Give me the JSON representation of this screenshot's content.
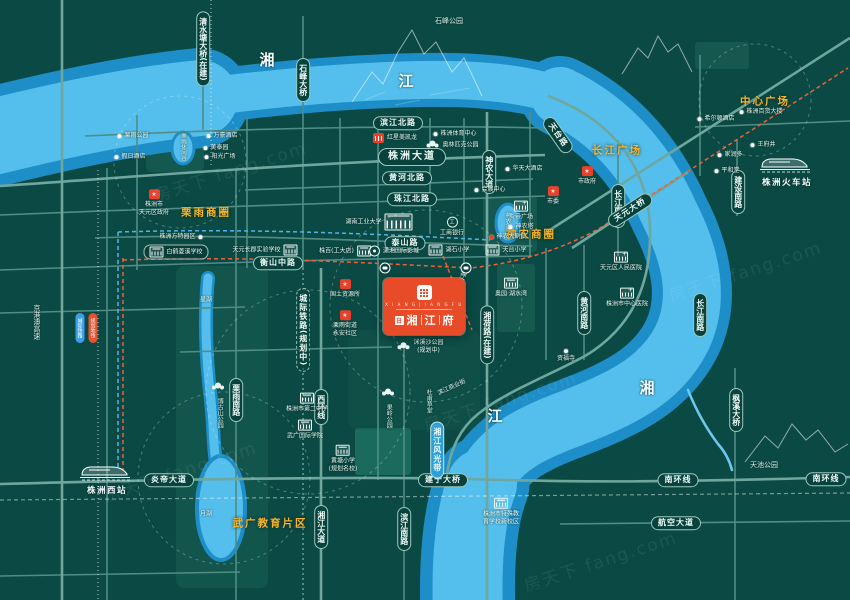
{
  "project": {
    "seal": "日",
    "name": [
      "湘",
      "江",
      "府"
    ],
    "latin": "X I A N G J I A N G F U"
  },
  "area_labels": [
    {
      "text": "栗雨商圈",
      "x": 206,
      "y": 212
    },
    {
      "text": "神农商圈",
      "x": 531,
      "y": 234
    },
    {
      "text": "长江广场",
      "x": 617,
      "y": 150
    },
    {
      "text": "中心广场",
      "x": 765,
      "y": 101
    },
    {
      "text": "武广教育片区",
      "x": 270,
      "y": 523
    }
  ],
  "road_labels": [
    {
      "text": "滨江北路",
      "x": 398,
      "y": 123,
      "style": "h"
    },
    {
      "text": "株洲大道",
      "x": 412,
      "y": 157,
      "style": "lg"
    },
    {
      "text": "黄河北路",
      "x": 407,
      "y": 178,
      "style": "h"
    },
    {
      "text": "珠江北路",
      "x": 412,
      "y": 199,
      "style": "h"
    },
    {
      "text": "泰山路",
      "x": 405,
      "y": 243,
      "style": "h"
    },
    {
      "text": "衡山中路",
      "x": 278,
      "y": 263,
      "style": "h"
    },
    {
      "text": "炎帝大道",
      "x": 169,
      "y": 480,
      "style": "h"
    },
    {
      "text": "建宁大桥",
      "x": 443,
      "y": 480,
      "style": "h"
    },
    {
      "text": "南环线",
      "x": 678,
      "y": 480,
      "style": "h"
    },
    {
      "text": "南环线",
      "x": 826,
      "y": 479,
      "style": "h"
    },
    {
      "text": "航空大道",
      "x": 676,
      "y": 523,
      "style": "h"
    },
    {
      "text": "神农大道",
      "x": 489,
      "y": 172,
      "style": "v"
    },
    {
      "text": "湘荷路(在建)",
      "x": 487,
      "y": 335,
      "style": "v"
    },
    {
      "text": "栗雨南路",
      "x": 236,
      "y": 400,
      "style": "v"
    },
    {
      "text": "西环线",
      "x": 321,
      "y": 407,
      "style": "v"
    },
    {
      "text": "湘江大道",
      "x": 321,
      "y": 527,
      "style": "v"
    },
    {
      "text": "滨江南路",
      "x": 404,
      "y": 529,
      "style": "v"
    },
    {
      "text": "黄河南路",
      "x": 584,
      "y": 313,
      "style": "v"
    },
    {
      "text": "长江南路",
      "x": 618,
      "y": 206,
      "style": "v"
    },
    {
      "text": "长江南路",
      "x": 700,
      "y": 315,
      "style": "v"
    },
    {
      "text": "建设南路",
      "x": 738,
      "y": 192,
      "style": "v"
    },
    {
      "text": "枫溪大桥",
      "x": 736,
      "y": 410,
      "style": "v"
    },
    {
      "text": "石峰大桥",
      "x": 303,
      "y": 80,
      "style": "v"
    },
    {
      "text": "清水塘大桥(在建)",
      "x": 203,
      "y": 49,
      "style": "v"
    },
    {
      "text": "湘江风光带",
      "x": 437,
      "y": 450,
      "style": "vblue"
    },
    {
      "text": "城际铁路(规划中)",
      "x": 303,
      "y": 330,
      "style": "vdash"
    },
    {
      "text": "天元大桥",
      "x": 630,
      "y": 210,
      "style": "h",
      "rot": -33
    },
    {
      "text": "天台路",
      "x": 558,
      "y": 135,
      "style": "h",
      "rot": 55
    }
  ],
  "plain_labels": [
    {
      "text": "湘",
      "x": 268,
      "y": 60,
      "size": 15,
      "cls": "big"
    },
    {
      "text": "江",
      "x": 407,
      "y": 81,
      "size": 15,
      "cls": "big"
    },
    {
      "text": "湘",
      "x": 648,
      "y": 388,
      "size": 15,
      "cls": "big"
    },
    {
      "text": "江",
      "x": 496,
      "y": 416,
      "size": 15,
      "cls": "big"
    },
    {
      "text": "石峰公园",
      "x": 449,
      "y": 22,
      "size": 7
    },
    {
      "text": "天池公园",
      "x": 764,
      "y": 466,
      "size": 7
    },
    {
      "text": "月湖",
      "x": 206,
      "y": 515,
      "size": 6
    },
    {
      "text": "星湖",
      "x": 206,
      "y": 301,
      "size": 6
    },
    {
      "text": "神农湖",
      "x": 507,
      "y": 221,
      "size": 6,
      "cls": "v"
    },
    {
      "text": "栗雨休闲谷",
      "x": 183,
      "y": 147,
      "size": 5.5,
      "cls": "v"
    },
    {
      "text": "京港澳高速",
      "x": 36,
      "y": 322,
      "size": 7,
      "cls": "v"
    },
    {
      "text": "果岭公园",
      "x": 388,
      "y": 416,
      "size": 6,
      "cls": "v"
    },
    {
      "text": "博古山公园",
      "x": 219,
      "y": 413,
      "size": 6,
      "cls": "v"
    },
    {
      "text": "杜甫草堂",
      "x": 428,
      "y": 401,
      "size": 6,
      "cls": "v"
    },
    {
      "text": "滨江商业街",
      "x": 452,
      "y": 388,
      "size": 6,
      "rot": -25
    },
    {
      "text": "神农生态景观轴",
      "x": 455,
      "y": 292,
      "size": 6.5,
      "cls": "v",
      "rot": 21
    }
  ],
  "poi": [
    {
      "icon": "store",
      "lay": "l",
      "x": 395,
      "y": 138,
      "lines": [
        "红星美凯龙"
      ]
    },
    {
      "icon": "dot",
      "lay": "l",
      "x": 455,
      "y": 134,
      "lines": [
        "株洲体育中心"
      ]
    },
    {
      "icon": "tree",
      "lay": "l",
      "x": 452,
      "y": 145,
      "lines": [
        "奥林匹克公园"
      ]
    },
    {
      "icon": "dot",
      "lay": "l",
      "x": 716,
      "y": 119,
      "lines": [
        "希尔顿酒店"
      ]
    },
    {
      "icon": "dot",
      "lay": "l",
      "x": 761,
      "y": 112,
      "lines": [
        "株洲百货大楼"
      ]
    },
    {
      "icon": "dot",
      "lay": "l",
      "x": 763,
      "y": 145,
      "lines": [
        "王府井"
      ]
    },
    {
      "icon": "dot",
      "lay": "l",
      "x": 730,
      "y": 155,
      "lines": [
        "家润多"
      ]
    },
    {
      "icon": "dot",
      "lay": "l",
      "x": 727,
      "y": 171,
      "lines": [
        "平和堂"
      ]
    },
    {
      "icon": "gov",
      "lay": "col",
      "x": 154,
      "y": 203,
      "lines": [
        "株洲市",
        "天元区政府"
      ]
    },
    {
      "icon": "dot",
      "lay": "r",
      "x": 181,
      "y": 237,
      "lines": [
        "株洲方特园区"
      ]
    },
    {
      "icon": "gov",
      "lay": "col",
      "x": 345,
      "y": 289,
      "lines": [
        "国土资源所"
      ]
    },
    {
      "icon": "gov",
      "lay": "col",
      "x": 345,
      "y": 324,
      "lines": [
        "栗雨街道",
        "永安社区"
      ]
    },
    {
      "icon": "school",
      "lay": "r",
      "x": 265,
      "y": 250,
      "lines": [
        "天元长郡实验学校"
      ]
    },
    {
      "icon": "school",
      "lay": "l",
      "x": 176,
      "y": 252,
      "cls": "boxed",
      "lines": [
        "白鹤菱溪学校"
      ]
    },
    {
      "icon": "school",
      "lay": "col",
      "x": 307,
      "y": 403,
      "lines": [
        "株洲市第二中学"
      ]
    },
    {
      "icon": "school",
      "lay": "col",
      "x": 305,
      "y": 430,
      "lines": [
        "武广国际学院"
      ]
    },
    {
      "icon": "school",
      "lay": "col",
      "x": 343,
      "y": 459,
      "lines": [
        "黄塘小学",
        "(规划名校)"
      ]
    },
    {
      "icon": "school",
      "lay": "l",
      "x": 449,
      "y": 250,
      "lines": [
        "湖石小学"
      ]
    },
    {
      "icon": "school",
      "lay": "l",
      "x": 506,
      "y": 250,
      "lines": [
        "天台小学"
      ]
    },
    {
      "icon": "school",
      "lay": "col",
      "x": 501,
      "y": 512,
      "lines": [
        "株洲市特殊教",
        "育学校新校区"
      ]
    },
    {
      "icon": "univ",
      "lay": "r",
      "x": 379,
      "y": 222,
      "cls": "unv",
      "lines": [
        "湖南工业大学"
      ]
    },
    {
      "icon": "school",
      "lay": "r",
      "x": 345,
      "y": 251,
      "lines": [
        "株百(工大店)"
      ]
    },
    {
      "icon": "movie",
      "lay": "l",
      "x": 394,
      "y": 251,
      "lines": [
        "潇湘国际影城"
      ]
    },
    {
      "icon": "bank",
      "lay": "col",
      "x": 452,
      "y": 227,
      "lines": [
        "工商银行"
      ]
    },
    {
      "icon": "hosp",
      "lay": "col",
      "x": 621,
      "y": 262,
      "lines": [
        "天元区人民医院"
      ]
    },
    {
      "icon": "hosp",
      "lay": "col",
      "x": 627,
      "y": 298,
      "lines": [
        "株洲市中心医院"
      ]
    },
    {
      "icon": "dot",
      "lay": "col",
      "x": 566,
      "y": 356,
      "lines": [
        "资福寺"
      ]
    },
    {
      "icon": "hosp",
      "lay": "col",
      "x": 521,
      "y": 211,
      "lines": [
        "炎帝广场"
      ]
    },
    {
      "icon": "dot",
      "lay": "l",
      "x": 521,
      "y": 227,
      "lines": [
        "神农塔"
      ]
    },
    {
      "icon": "dotred",
      "lay": "l",
      "x": 508,
      "y": 237,
      "lines": [
        "神农大剧院"
      ]
    },
    {
      "icon": "dot",
      "lay": "l",
      "x": 490,
      "y": 190,
      "lines": [
        "会展中心"
      ]
    },
    {
      "icon": "dot",
      "lay": "l",
      "x": 524,
      "y": 169,
      "lines": [
        "华天大酒店"
      ]
    },
    {
      "icon": "school",
      "lay": "col",
      "x": 511,
      "y": 288,
      "lines": [
        "奥园·湖水湾"
      ]
    },
    {
      "icon": "tree",
      "lay": "l",
      "x": 420,
      "y": 347,
      "lines": [
        "洣溪沙公园",
        "(规划中)"
      ]
    },
    {
      "icon": "dot",
      "lay": "l",
      "x": 133,
      "y": 136,
      "lines": [
        "栗雨公园"
      ]
    },
    {
      "icon": "dot",
      "lay": "l",
      "x": 130,
      "y": 157,
      "lines": [
        "假日酒店"
      ]
    },
    {
      "icon": "dot",
      "lay": "l",
      "x": 222,
      "y": 136,
      "lines": [
        "万豪酒店"
      ]
    },
    {
      "icon": "dot",
      "lay": "l",
      "x": 216,
      "y": 148,
      "lines": [
        "美泰园"
      ]
    },
    {
      "icon": "dot",
      "lay": "l",
      "x": 220,
      "y": 157,
      "lines": [
        "阳光广场"
      ]
    },
    {
      "icon": "gov",
      "lay": "col",
      "x": 587,
      "y": 176,
      "lines": [
        "市政府"
      ]
    },
    {
      "icon": "gov",
      "lay": "col",
      "x": 553,
      "y": 196,
      "lines": [
        "市委"
      ]
    },
    {
      "icon": "tree",
      "lay": "col",
      "x": 388,
      "y": 393,
      "lines": []
    },
    {
      "icon": "tree",
      "lay": "col",
      "x": 218,
      "y": 387,
      "lines": []
    }
  ],
  "stations": [
    {
      "name": "株洲火车站",
      "x": 787,
      "y": 176,
      "ix": 762,
      "iy": 156
    },
    {
      "name": "株洲西站",
      "x": 107,
      "y": 484,
      "ix": 81,
      "iy": 464
    }
  ],
  "transit": {
    "pills": [
      {
        "text": "城际铁路",
        "x": 80,
        "y": 328,
        "color": "#3aa0e8"
      },
      {
        "text": "规划地铁",
        "x": 93,
        "y": 328,
        "color": "#e8502e"
      }
    ],
    "bus_stops": [
      {
        "x": 385,
        "y": 268
      },
      {
        "x": 466,
        "y": 268
      }
    ]
  },
  "watermark": {
    "text": "房天下 fang.com",
    "spots": [
      {
        "x": 230,
        "y": 170
      },
      {
        "x": 500,
        "y": 400
      },
      {
        "x": 745,
        "y": 270
      },
      {
        "x": 180,
        "y": 470
      },
      {
        "x": 600,
        "y": 560
      }
    ]
  }
}
